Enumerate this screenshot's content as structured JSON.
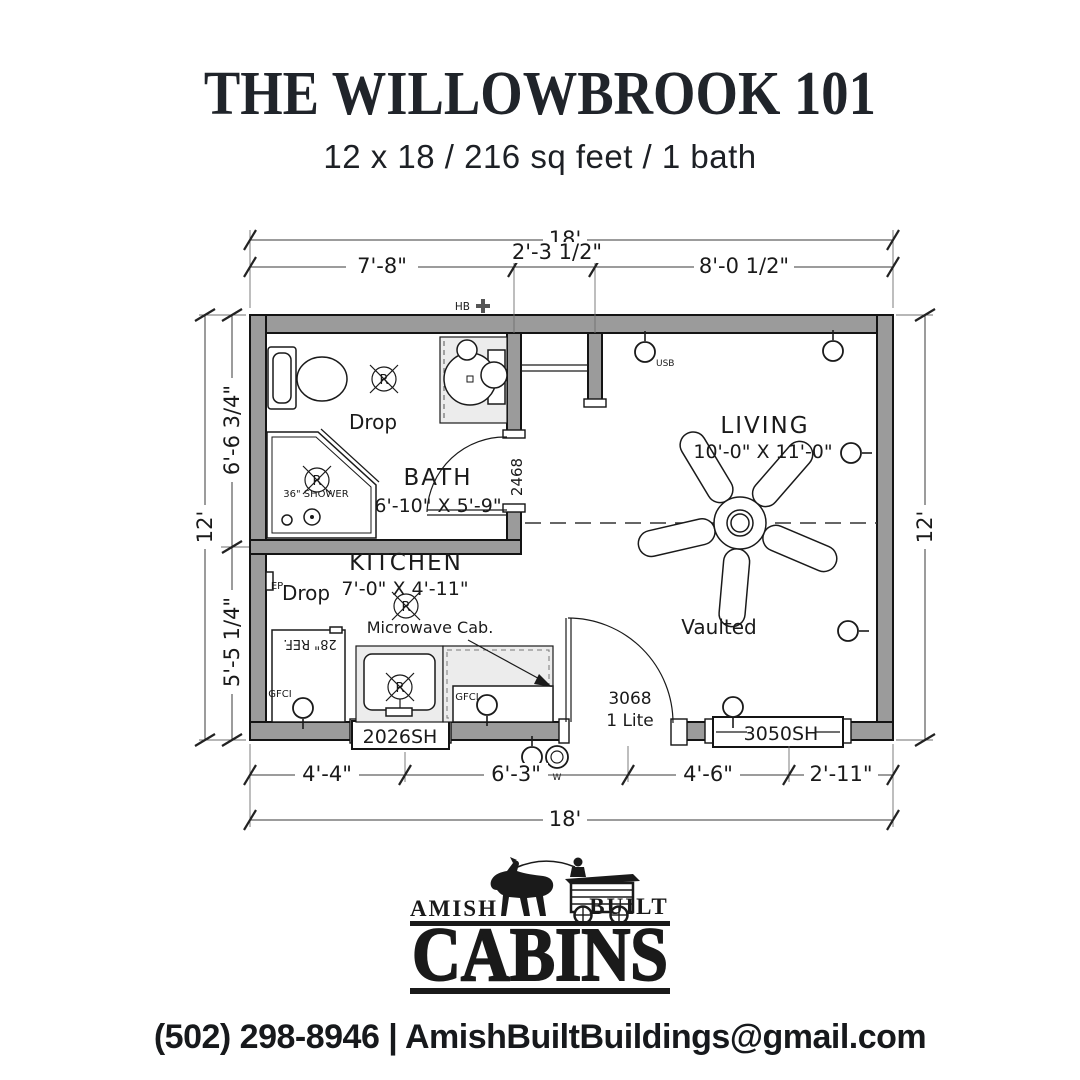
{
  "header": {
    "title": "THE WILLOWBROOK 101",
    "subtitle": "12 x 18 / 216 sq feet / 1 bath"
  },
  "plan": {
    "dims": {
      "overall_width_top": "18'",
      "overall_width_bottom": "18'",
      "overall_height_left": "12'",
      "overall_height_right": "12'",
      "top_seg_1": "7'-8\"",
      "top_seg_2": "2'-3 1/2\"",
      "top_seg_3": "8'-0 1/2\"",
      "left_seg_1": "6'-6 3/4\"",
      "left_seg_2": "5'-5 1/4\"",
      "bottom_seg_1": "4'-4\"",
      "bottom_seg_2": "6'-3\"",
      "bottom_seg_3": "4'-6\"",
      "bottom_seg_4": "2'-11\""
    },
    "rooms": {
      "bath_name": "BATH",
      "bath_size": "6'-10\" X 5'-9\"",
      "kitchen_name": "KITCHEN",
      "kitchen_size": "7'-0\" X 4'-11\"",
      "living_name": "LIVING",
      "living_size": "10'-0\" X 11'-0\"",
      "living_note": "Vaulted"
    },
    "fixtures": {
      "shower": "36\" SHOWER",
      "fridge": "28\" REF.",
      "microwave": "Microwave Cab.",
      "drop_bath": "Drop",
      "drop_kitchen": "Drop",
      "ep": "EP",
      "hb": "HB",
      "usb": "USB",
      "gfci_1": "GFCI",
      "gfci_2": "GFCI",
      "weatherproof": "W",
      "recessed_light": "R"
    },
    "openings": {
      "window_kitchen": "2026SH",
      "window_living": "3050SH",
      "door_front_model": "3068",
      "door_front_type": "1 Lite",
      "door_bath": "2468"
    }
  },
  "footer": {
    "brand_left": "AMISH",
    "brand_right": "BUILT",
    "brand_main": "CABINS",
    "contact": "(502) 298-8946 | AmishBuiltBuildings@gmail.com"
  }
}
